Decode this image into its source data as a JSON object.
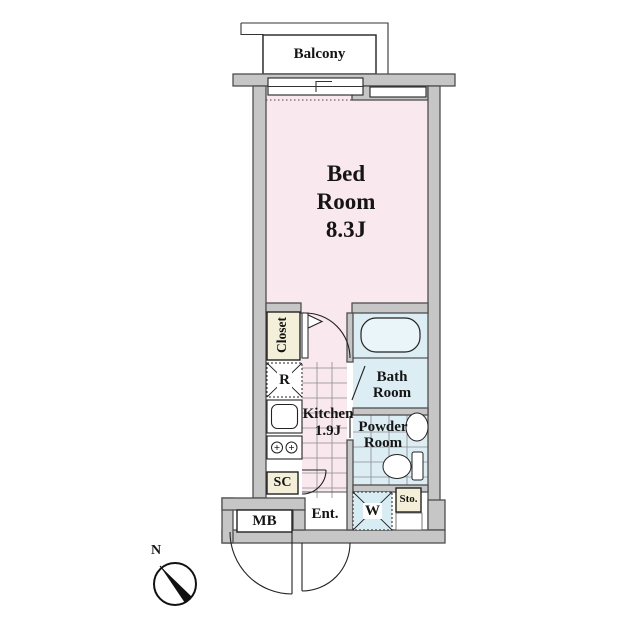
{
  "rooms": {
    "balcony": {
      "name": "Balcony"
    },
    "bedroom": {
      "name_lines": [
        "Bed",
        "Room"
      ],
      "size": "8.3J"
    },
    "closet": {
      "name": "Closet"
    },
    "kitchen": {
      "name": "Kitchen",
      "size": "1.9J"
    },
    "bathroom": {
      "name_lines": [
        "Bath",
        "Room"
      ]
    },
    "powder_room": {
      "name_lines": [
        "Powder",
        "Room"
      ]
    },
    "entrance": {
      "name": "Ent."
    },
    "storage": {
      "name": "Sto."
    }
  },
  "fixtures": {
    "refrigerator": {
      "abbr": "R"
    },
    "washer": {
      "abbr": "W"
    },
    "shoe_cabinet": {
      "abbr": "SC"
    },
    "meter_box": {
      "abbr": "MB"
    }
  },
  "compass": {
    "north": "N"
  },
  "colors": {
    "room_pink": "#f9e9ef",
    "wet_area_blue": "#dcedf4",
    "storage_cream": "#f3efd8",
    "wall_fill": "#c6c6c6",
    "wall_outline": "#4f4f4f",
    "line": "#222222",
    "background": "#ffffff"
  }
}
